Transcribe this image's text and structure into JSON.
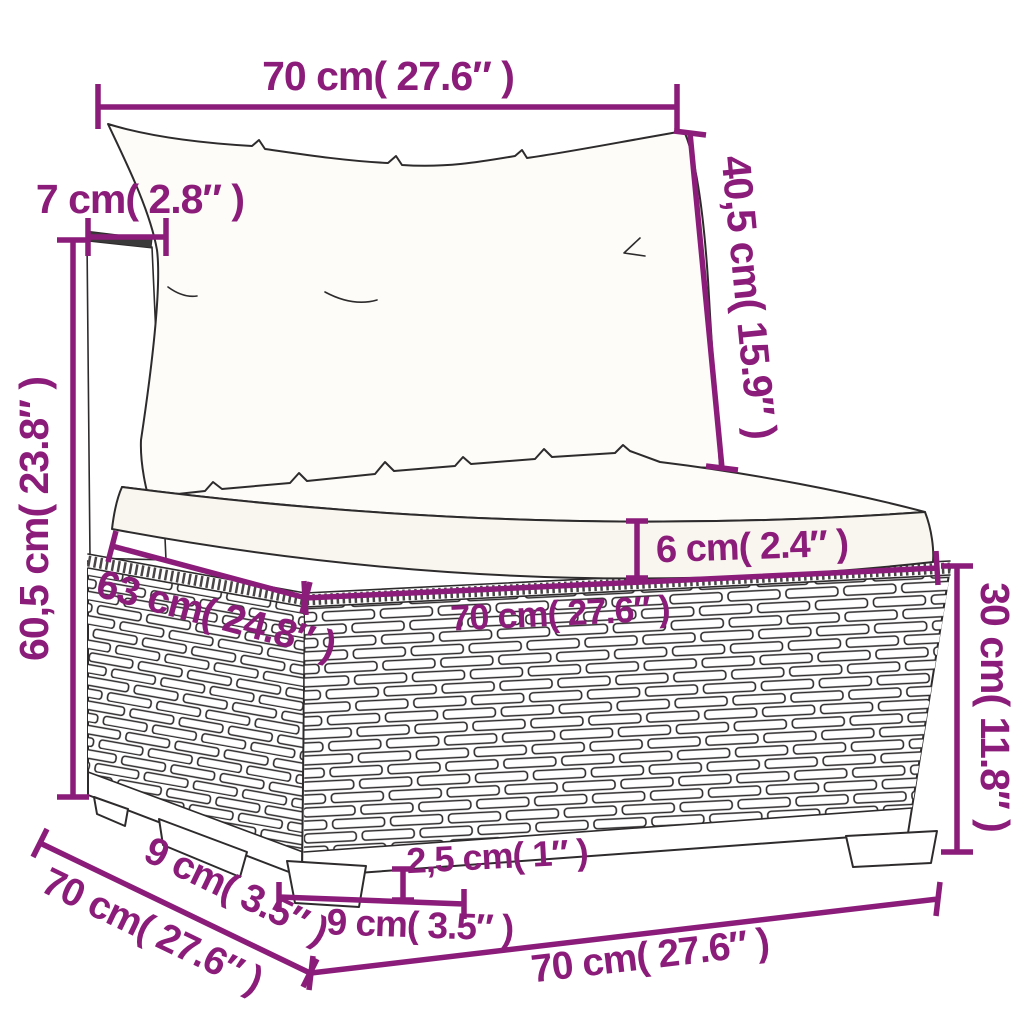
{
  "style": {
    "accent": "#8B1C79",
    "line_color": "#2e2b2c",
    "background": "#ffffff"
  },
  "diagram": {
    "type": "furniture-dimension-diagram",
    "subject": "poly-rattan-garden-sofa-middle-section-with-cushions",
    "dimensions": {
      "back_width": "70 cm( 27.6″ )",
      "panel_thickness": "7 cm( 2.8″ )",
      "backrest_height": "40,5 cm( 15.9″ )",
      "total_height": "60,5 cm( 23.8″ )",
      "seat_cushion_thickness": "6 cm( 2.4″ )",
      "seat_width": "70 cm( 27.6″ )",
      "seat_depth": "63 cm( 24.8″ )",
      "base_height": "30 cm( 11.8″ )",
      "foot_span_side": "9 cm( 3.5″ )",
      "side_depth": "70 cm( 27.6″ )",
      "foot_height": "2,5 cm( 1″ )",
      "foot_width": "9 cm( 3.5″ )",
      "front_width": "70 cm( 27.6″ )"
    }
  }
}
